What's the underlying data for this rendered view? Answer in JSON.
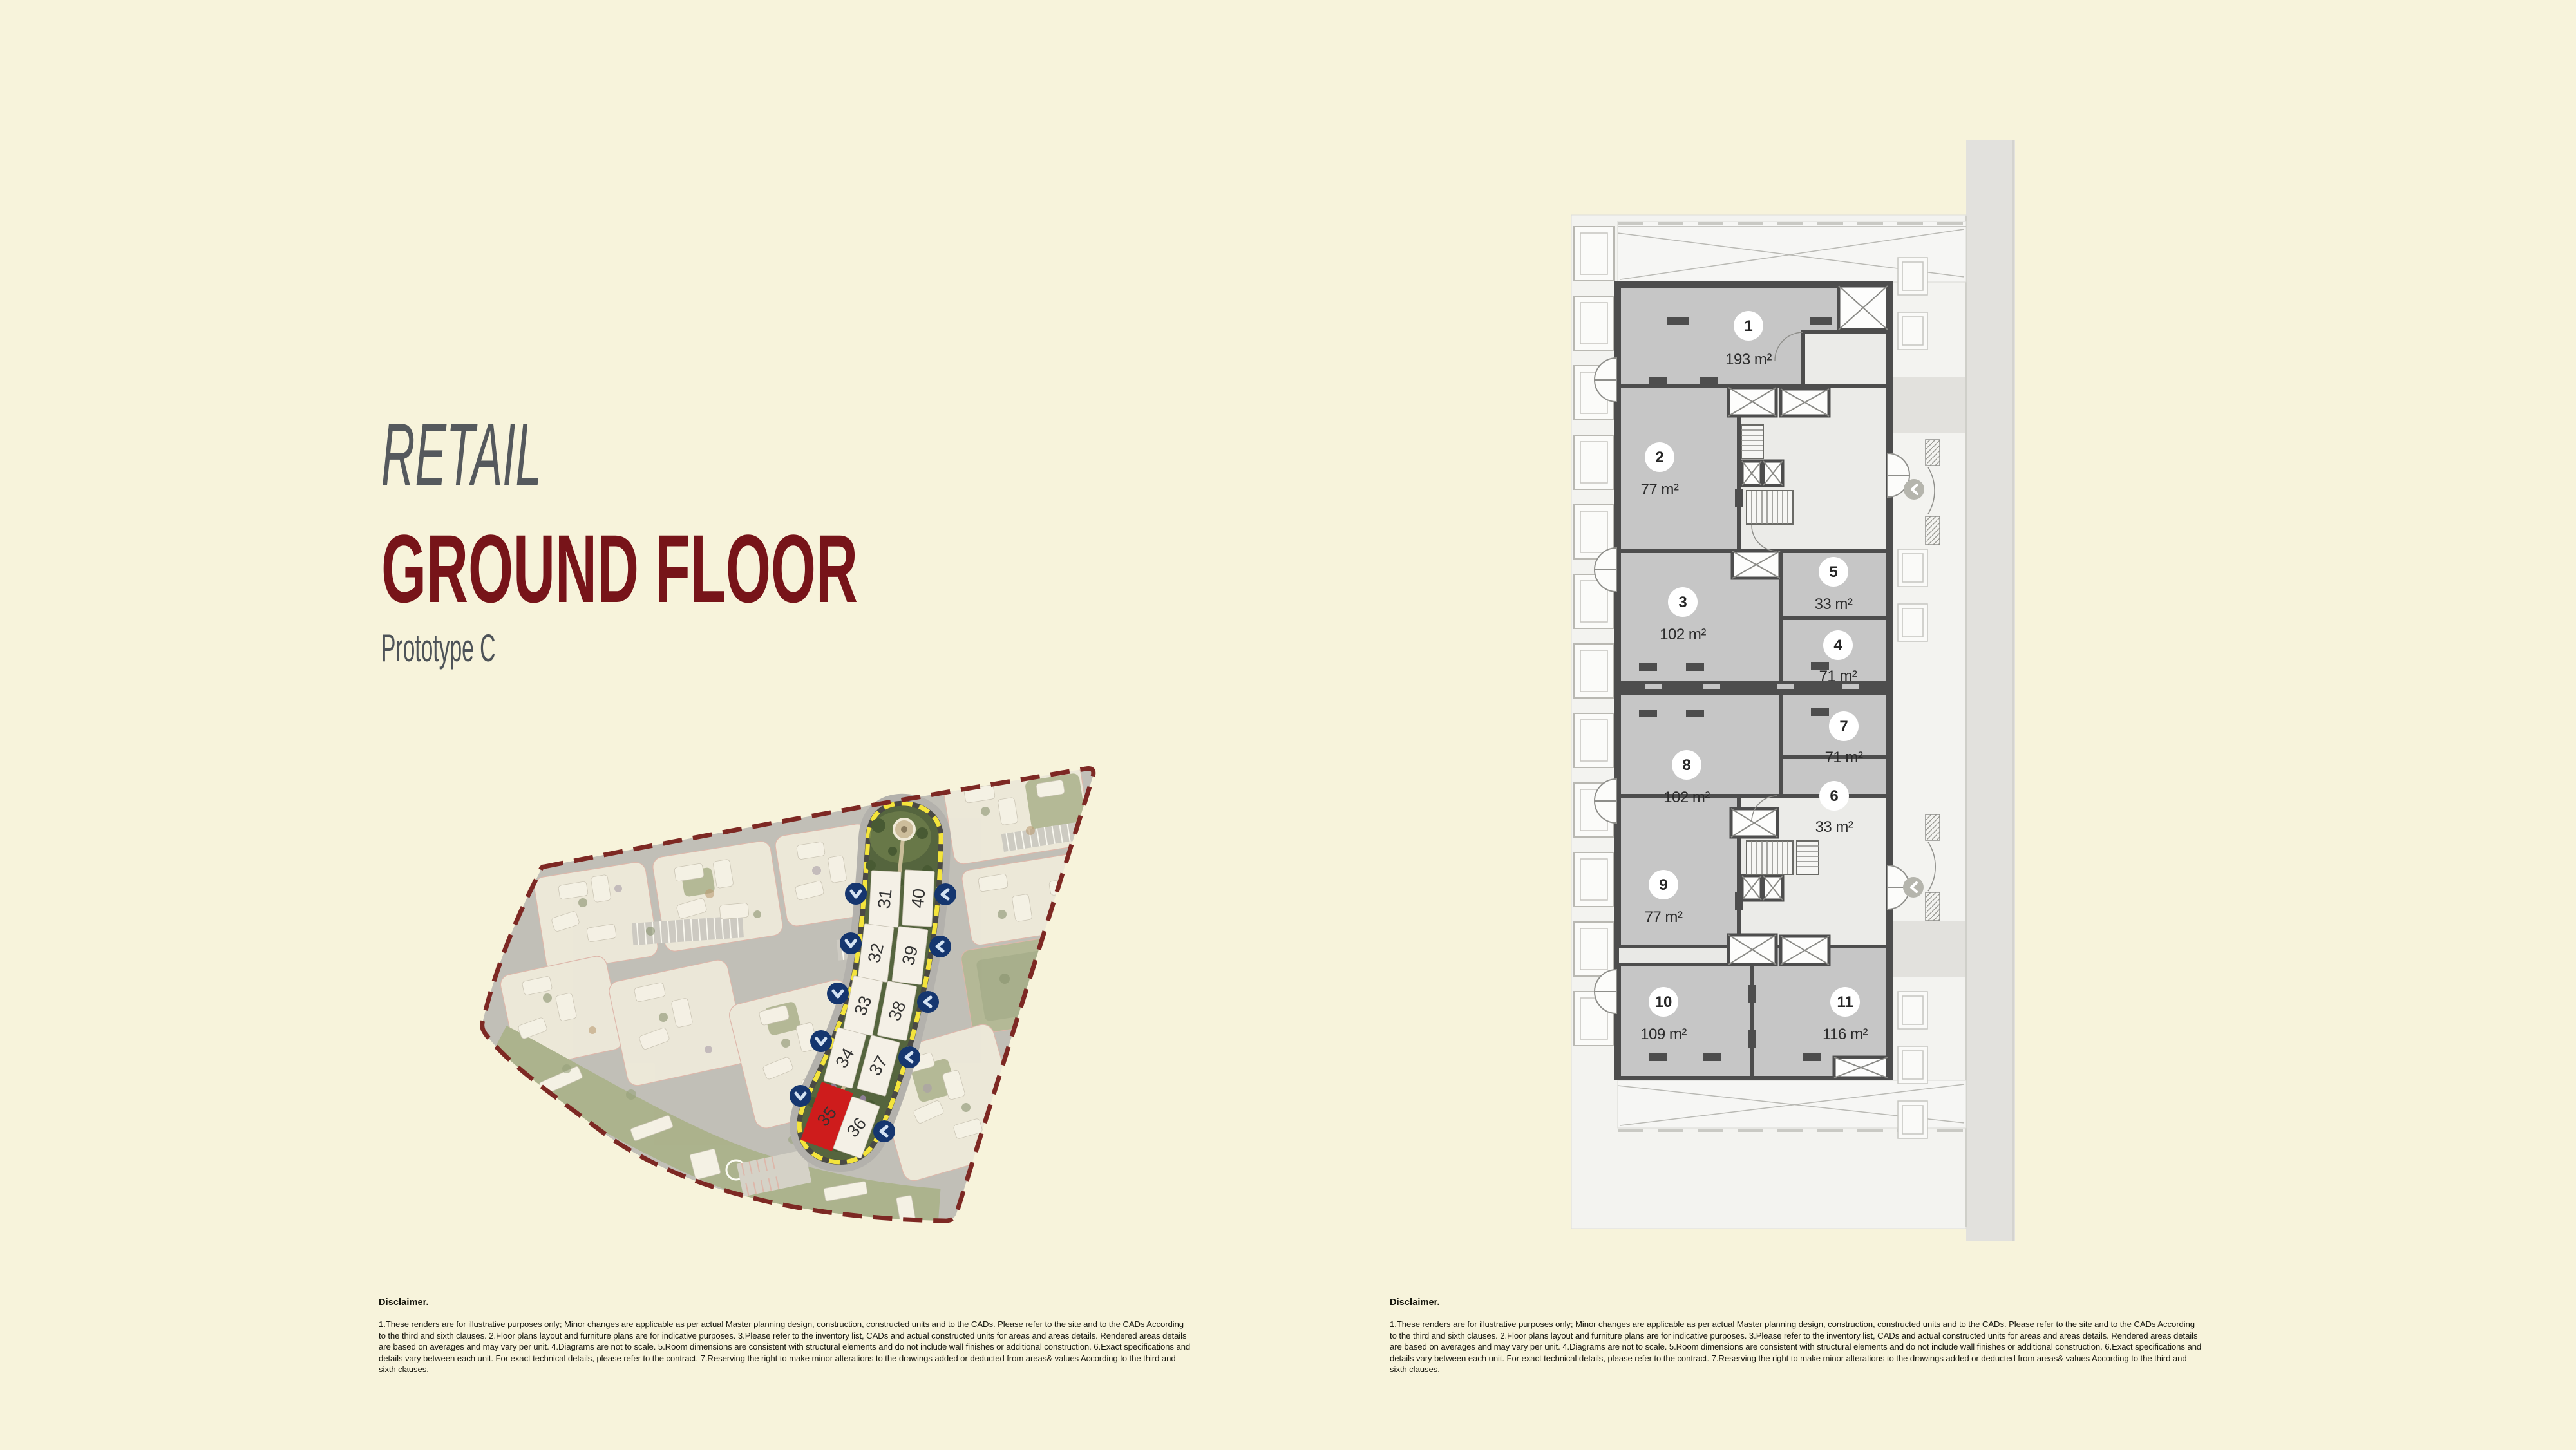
{
  "page": {
    "background_color": "#f7f3db",
    "accent_maroon": "#771419",
    "accent_yellow": "#f4e43c",
    "accent_navy": "#15366f",
    "selected_red": "#ce1c1c"
  },
  "titles": {
    "category": "RETAIL",
    "page_title": "GROUND FLOOR",
    "subtitle": "Prototype C"
  },
  "site_map": {
    "boundary_color": "#7d2823",
    "highlight_outline_color": "#f4e43c",
    "marker_color": "#15366f",
    "selected_building": "35",
    "selected_fill": "#ce1c1c",
    "marker_icons": {
      "left_column": "chevron-down",
      "right_column": "chevron-left"
    },
    "buildings": [
      {
        "num": "31",
        "highlighted": false
      },
      {
        "num": "40",
        "highlighted": false
      },
      {
        "num": "32",
        "highlighted": false
      },
      {
        "num": "39",
        "highlighted": false
      },
      {
        "num": "33",
        "highlighted": false
      },
      {
        "num": "38",
        "highlighted": false
      },
      {
        "num": "34",
        "highlighted": false
      },
      {
        "num": "37",
        "highlighted": false
      },
      {
        "num": "35",
        "highlighted": true
      },
      {
        "num": "36",
        "highlighted": false
      }
    ]
  },
  "floor_plan": {
    "marker_icon": "chevron-left",
    "units": [
      {
        "num": "1",
        "area": "193 m²"
      },
      {
        "num": "2",
        "area": "77 m²"
      },
      {
        "num": "3",
        "area": "102 m²"
      },
      {
        "num": "4",
        "area": "71 m²"
      },
      {
        "num": "5",
        "area": "33 m²"
      },
      {
        "num": "6",
        "area": "33 m²"
      },
      {
        "num": "7",
        "area": "71 m²"
      },
      {
        "num": "8",
        "area": "102 m²"
      },
      {
        "num": "9",
        "area": "77 m²"
      },
      {
        "num": "10",
        "area": "109 m²"
      },
      {
        "num": "11",
        "area": "116 m²"
      }
    ]
  },
  "disclaimer": {
    "heading": "Disclaimer.",
    "body": "1.These renders are for illustrative purposes only; Minor changes are applicable as per actual Master planning design, construction, constructed units and to the CADs. Please refer to the site and to the CADs According to the third and sixth clauses. 2.Floor plans layout and furniture plans are for indicative purposes. 3.Please refer to the inventory list, CADs and actual constructed units for areas and areas details. Rendered areas details are based on averages and may vary per unit. 4.Diagrams are not to scale. 5.Room dimensions are consistent with structural elements and do not include wall finishes or additional construction. 6.Exact specifications and details vary between each unit. For exact technical details, please refer to the contract. 7.Reserving the right to make minor alterations to the drawings  added or deducted from areas& values According to the third and sixth clauses."
  }
}
